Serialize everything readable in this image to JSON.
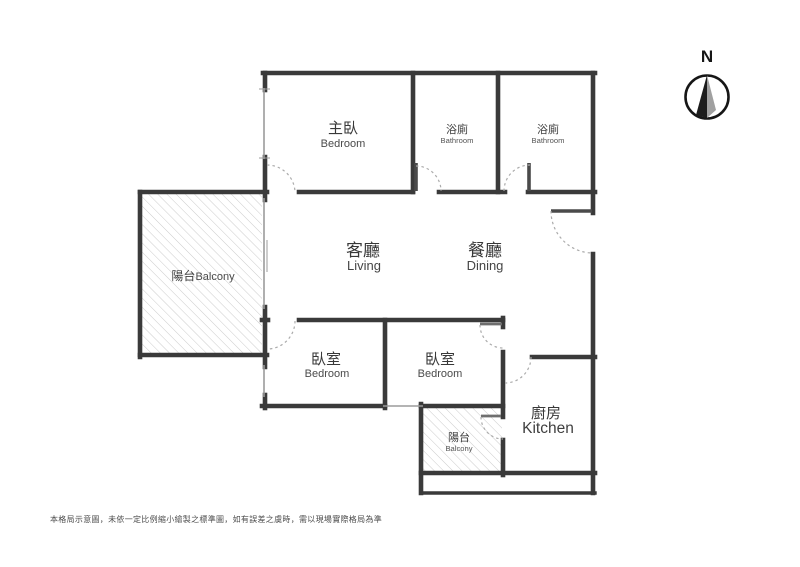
{
  "colors": {
    "background": "#ffffff",
    "wall": "#3a3a3a",
    "window": "#9b9b9b",
    "door_arc": "#ababab",
    "hatch": "#c6c6c6",
    "label_zh": "#383838",
    "label_en": "#4a4a4a",
    "compass_needle_dark": "#1c1c1c",
    "compass_needle_light": "#a0a0a0"
  },
  "compass": {
    "label": "N"
  },
  "rooms": {
    "master_bedroom": {
      "zh": "主臥",
      "en": "Bedroom"
    },
    "bathroom_1": {
      "zh": "浴廁",
      "en": "Bathroom"
    },
    "bathroom_2": {
      "zh": "浴廁",
      "en": "Bathroom"
    },
    "living": {
      "zh": "客廳",
      "en": "Living"
    },
    "dining": {
      "zh": "餐廳",
      "en": "Dining"
    },
    "balcony_left": {
      "zh": "陽台",
      "en": "Balcony"
    },
    "bedroom_2": {
      "zh": "臥室",
      "en": "Bedroom"
    },
    "bedroom_3": {
      "zh": "臥室",
      "en": "Bedroom"
    },
    "kitchen": {
      "zh": "廚房",
      "en": "Kitchen"
    },
    "balcony_rear": {
      "zh": "陽台",
      "en": "Balcony"
    }
  },
  "disclaimer": "本格局示意圖，未依一定比例縮小繪製之標準圖，如有誤差之虞時，需以現場實際格局為準"
}
